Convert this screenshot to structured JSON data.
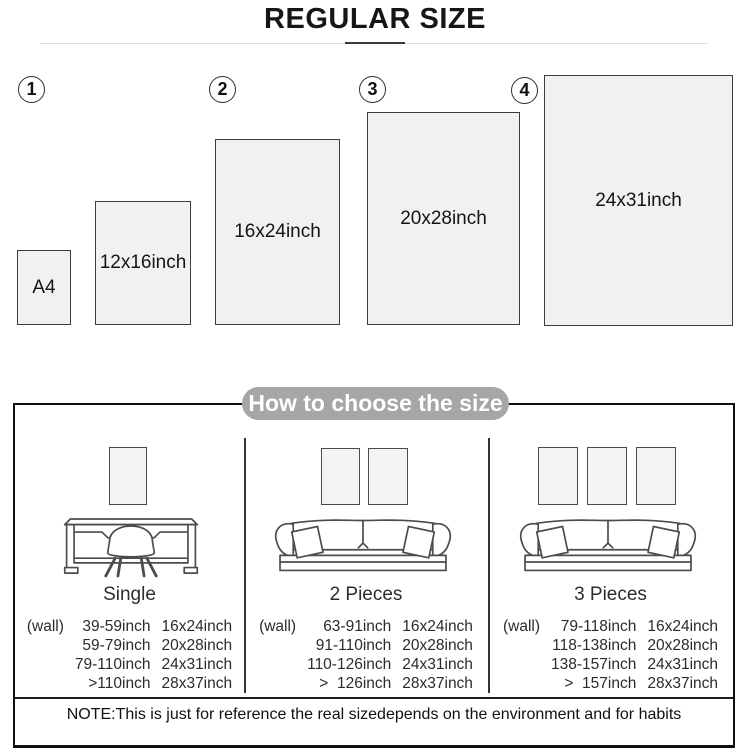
{
  "title": "REGULAR SIZE",
  "size_chart": {
    "badges": [
      "1",
      "2",
      "3",
      "4"
    ],
    "boxes": [
      {
        "label": "A4"
      },
      {
        "label": "12x16inch"
      },
      {
        "label": "16x24inch"
      },
      {
        "label": "20x28inch"
      },
      {
        "label": "24x31inch"
      }
    ]
  },
  "guide": {
    "header": "How to choose the size",
    "panels": [
      {
        "label": "Single",
        "wall_label": "(wall)",
        "rows": [
          {
            "range": "39-59inch",
            "size": "16x24inch"
          },
          {
            "range": "59-79inch",
            "size": "20x28inch"
          },
          {
            "range": "79-110inch",
            "size": "24x31inch"
          },
          {
            "range": ">110inch",
            "size": "28x37inch"
          }
        ]
      },
      {
        "label": "2 Pieces",
        "wall_label": "(wall)",
        "rows": [
          {
            "range": "63-91inch",
            "size": "16x24inch"
          },
          {
            "range": "91-110inch",
            "size": "20x28inch"
          },
          {
            "range": "110-126inch",
            "size": "24x31inch"
          },
          {
            "range": ">  126inch",
            "size": "28x37inch"
          }
        ]
      },
      {
        "label": "3 Pieces",
        "wall_label": "(wall)",
        "rows": [
          {
            "range": "79-118inch",
            "size": "16x24inch"
          },
          {
            "range": "118-138inch",
            "size": "20x28inch"
          },
          {
            "range": "138-157inch",
            "size": "24x31inch"
          },
          {
            "range": ">  157inch",
            "size": "28x37inch"
          }
        ]
      }
    ],
    "note": "NOTE:This is just for reference the real sizedepends on the environment and for habits"
  },
  "colors": {
    "box_fill": "#f1f1f2",
    "box_border": "#3d3d3d",
    "pill_bg": "#a6a6a6",
    "pill_text": "#ffffff",
    "hairline_gray": "#dedede",
    "outline_ink": "#101010"
  }
}
